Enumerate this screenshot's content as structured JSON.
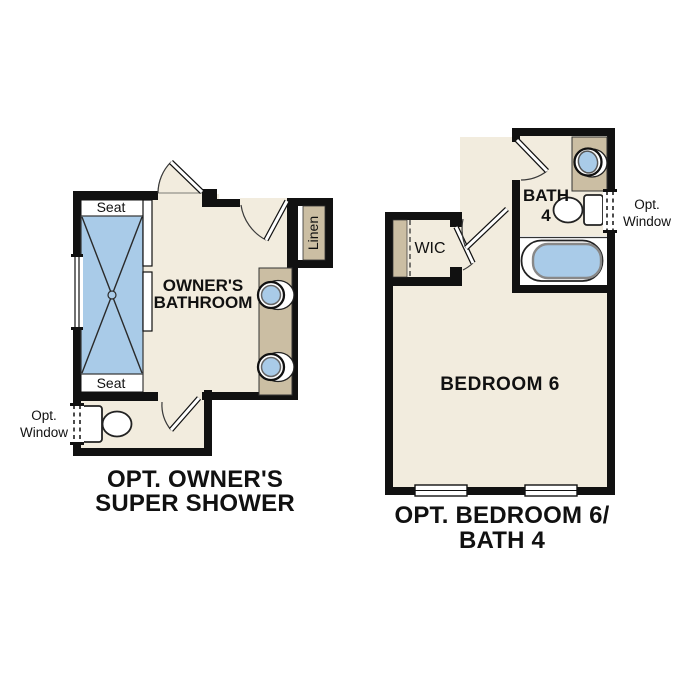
{
  "colors": {
    "floor": "#F2ECDE",
    "wall": "#111111",
    "fixture_tan": "#CBBEA3",
    "water_blue": "#A9CBE8",
    "white": "#FFFFFF",
    "line": "#333333"
  },
  "left_plan": {
    "title_line1": "OPT. OWNER'S",
    "title_line2": "SUPER SHOWER",
    "room_label_line1": "OWNER'S",
    "room_label_line2": "BATHROOM",
    "shower_seat_top": "Seat",
    "shower_seat_bottom": "Seat",
    "linen_label": "Linen",
    "opt_window_line1": "Opt.",
    "opt_window_line2": "Window"
  },
  "right_plan": {
    "title_line1": "OPT. BEDROOM 6/",
    "title_line2": "BATH 4",
    "bedroom_label": "BEDROOM 6",
    "bath_label_line1": "BATH",
    "bath_label_line2": "4",
    "wic_label": "WIC",
    "opt_window_line1": "Opt.",
    "opt_window_line2": "Window"
  }
}
